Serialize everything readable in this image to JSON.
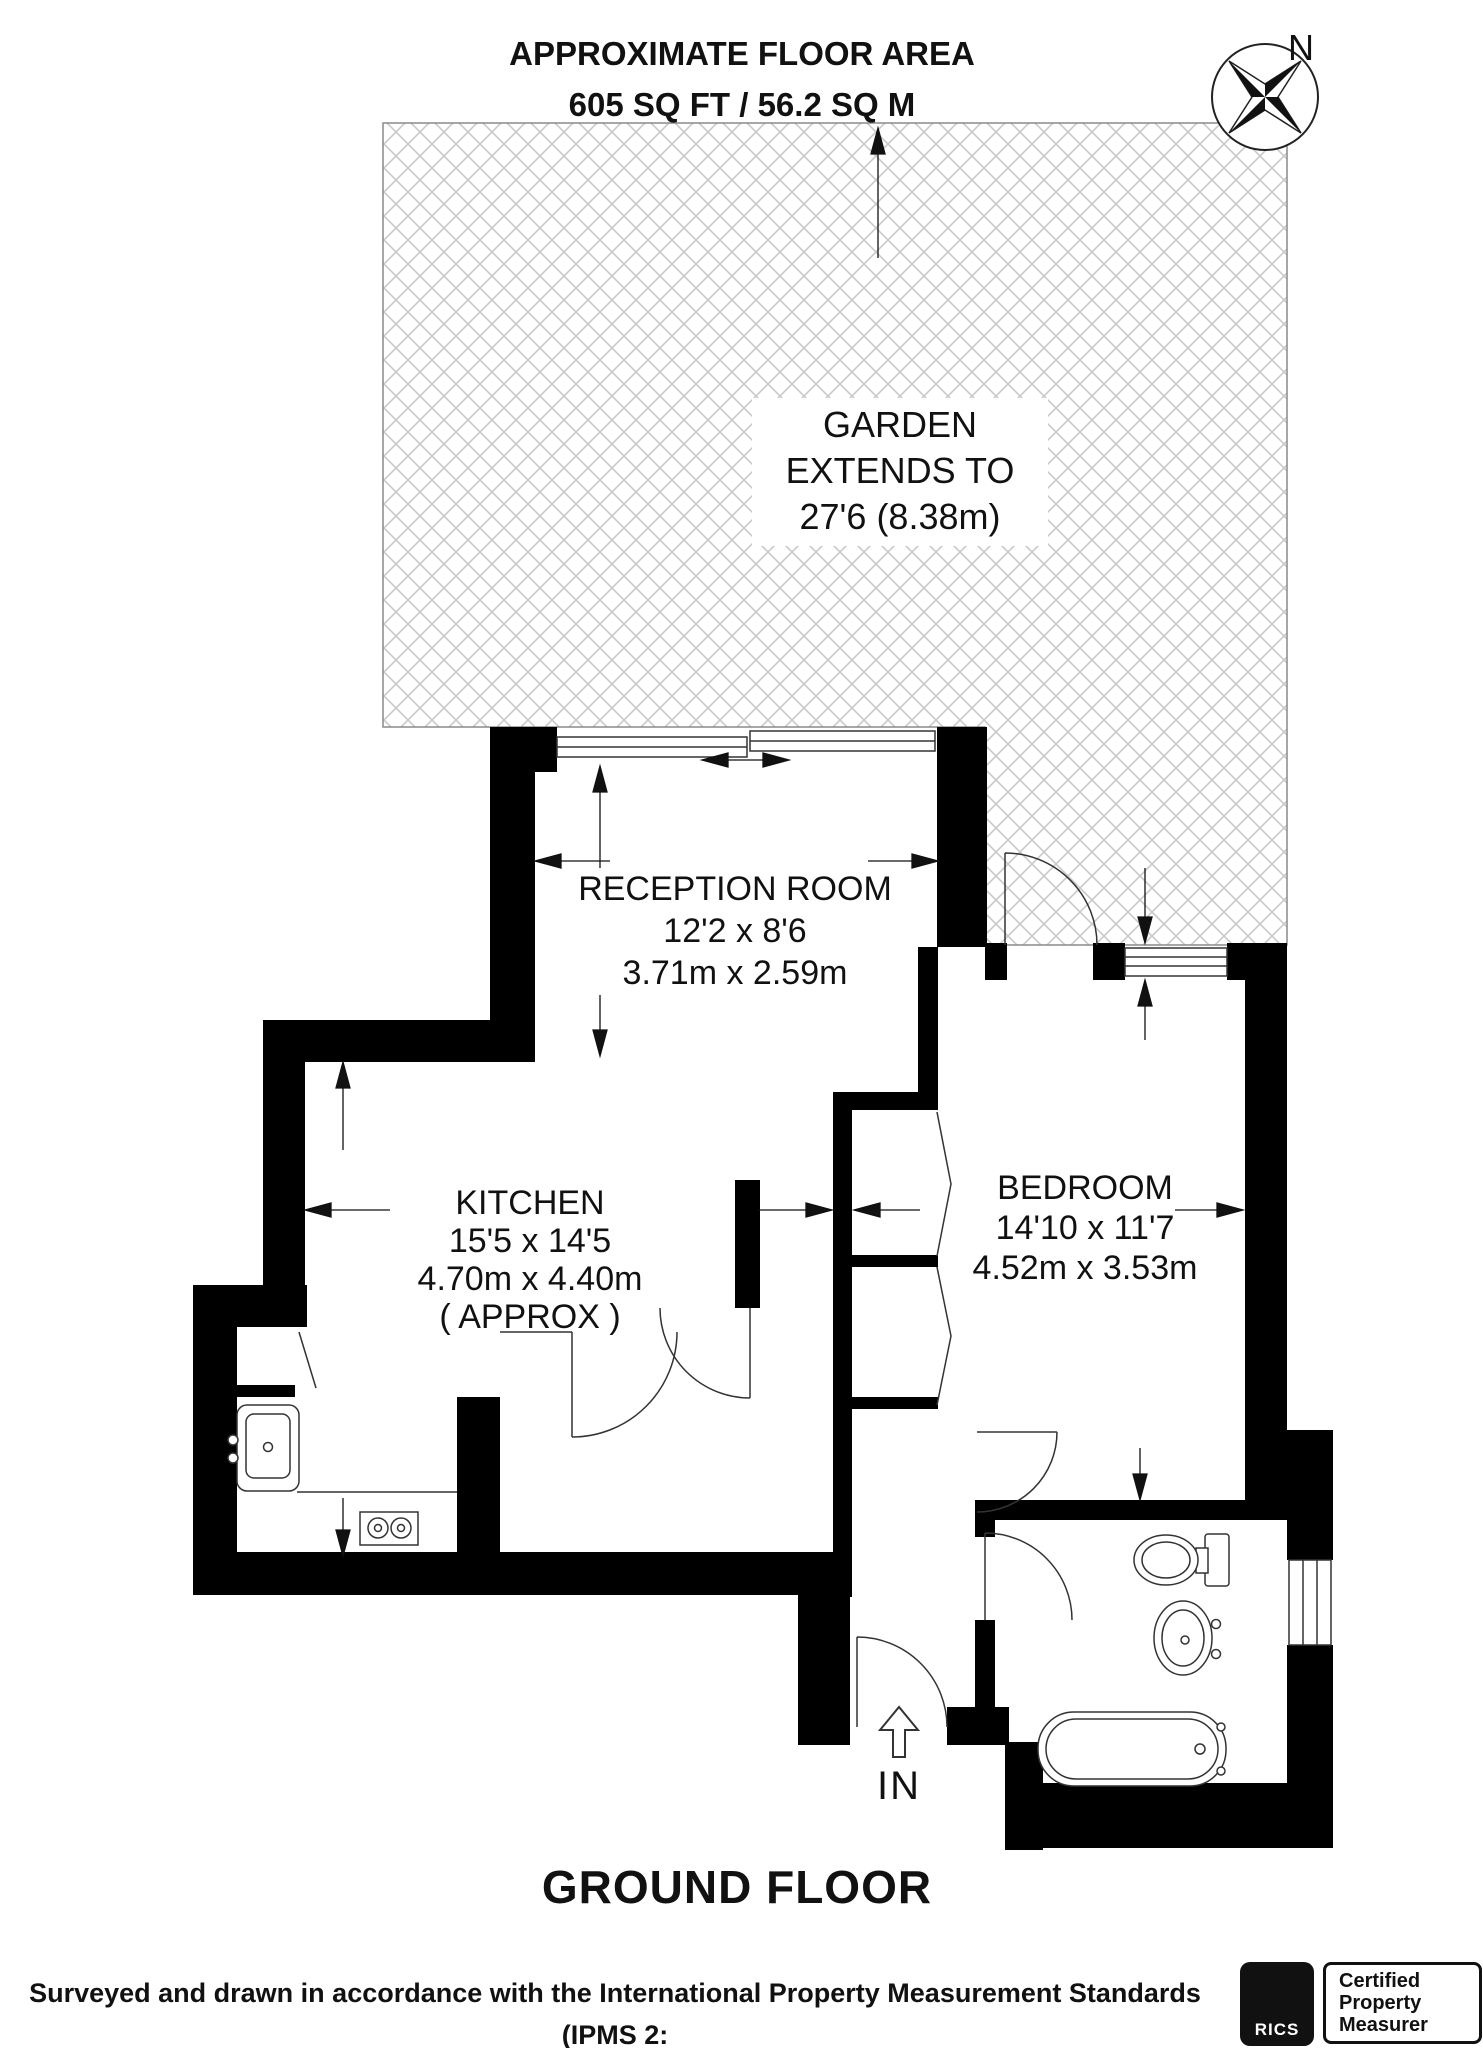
{
  "header": {
    "title": "APPROXIMATE FLOOR AREA",
    "subtitle": "605 SQ FT / 56.2 SQ M"
  },
  "compass": {
    "label": "N"
  },
  "rooms": {
    "garden": {
      "lines": [
        "GARDEN",
        "EXTENDS TO",
        "27'6 (8.38m)"
      ]
    },
    "reception": {
      "name": "RECEPTION ROOM",
      "imperial": "12'2 x 8'6",
      "metric": "3.71m x 2.59m"
    },
    "kitchen": {
      "name": "KITCHEN",
      "imperial": "15'5 x 14'5",
      "metric": "4.70m x 4.40m",
      "note": "( APPROX )"
    },
    "bedroom": {
      "name": "BEDROOM",
      "imperial": "14'10 x 11'7",
      "metric": "4.52m x 3.53m"
    }
  },
  "entrance": {
    "label": "IN"
  },
  "floor_label": "GROUND FLOOR",
  "footer": {
    "line1": "Surveyed and drawn in accordance with the International Property Measurement Standards (IPMS 2:",
    "line2": "Residential) FOXTONS.CO.UK"
  },
  "badges": {
    "rics": "RICS",
    "certification": [
      "Certified",
      "Property",
      "Measurer"
    ]
  },
  "palette": {
    "wall": "#000000",
    "hatch": "#c9c9c9",
    "line": "#333333",
    "background": "#ffffff"
  }
}
